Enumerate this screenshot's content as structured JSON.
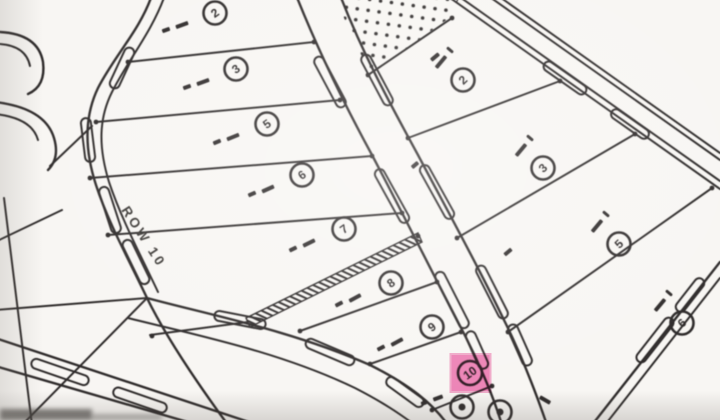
{
  "map": {
    "description": "scanned subdivision plat map",
    "road_label": "ROW 10",
    "paper_color": "#f8f6f3",
    "ink_color": "#2e2c2b",
    "highlight": {
      "lot": "10",
      "fill": "#f27ab7",
      "edge": "#f5a6cd",
      "ink": "#3b1128"
    },
    "left_block_lots": [
      {
        "n": "2",
        "x": 215,
        "y": 13
      },
      {
        "n": "3",
        "x": 236,
        "y": 69
      },
      {
        "n": "5",
        "x": 267,
        "y": 124
      },
      {
        "n": "6",
        "x": 302,
        "y": 175
      },
      {
        "n": "7",
        "x": 344,
        "y": 229
      },
      {
        "n": "8",
        "x": 391,
        "y": 283
      },
      {
        "n": "9",
        "x": 432,
        "y": 327
      },
      {
        "n": "10",
        "x": 470,
        "y": 373,
        "highlighted": true
      }
    ],
    "right_block_lots": [
      {
        "n": "2",
        "x": 463,
        "y": 80
      },
      {
        "n": "3",
        "x": 543,
        "y": 168
      },
      {
        "n": "5",
        "x": 619,
        "y": 244
      },
      {
        "n": "6",
        "x": 682,
        "y": 323
      }
    ],
    "partial_edge_lots": [
      {
        "n": "",
        "x": 462,
        "y": 407
      },
      {
        "n": "",
        "x": 500,
        "y": 412
      }
    ]
  }
}
